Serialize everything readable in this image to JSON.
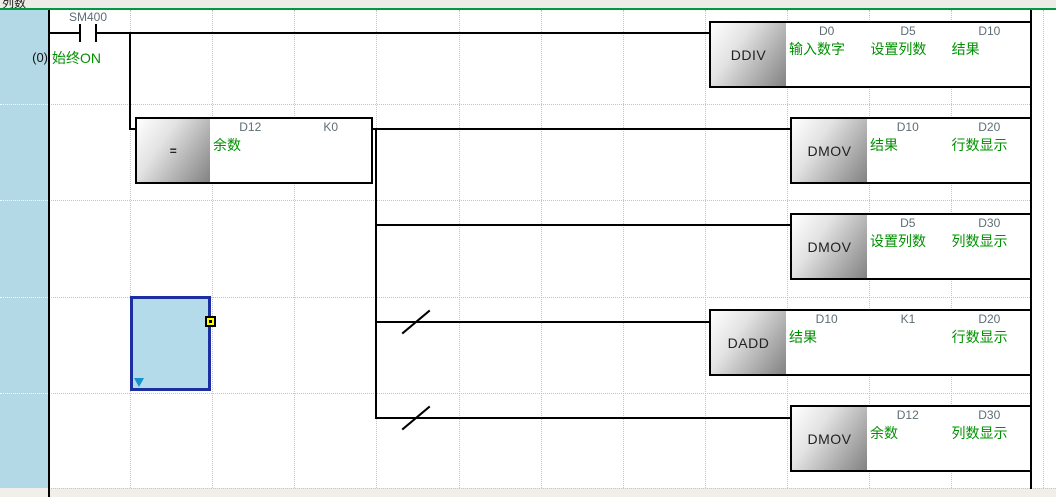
{
  "title_bar": {
    "comment": "列数"
  },
  "ladder": {
    "step_number": "(0)",
    "contact": {
      "device": "SM400",
      "comment": "始终ON"
    },
    "blocks": [
      {
        "instruction": "DDIV",
        "operands": [
          {
            "device": "D0",
            "comment": "输入数字"
          },
          {
            "device": "D5",
            "comment": "设置列数"
          },
          {
            "device": "D10",
            "comment": "结果"
          }
        ]
      },
      {
        "instruction": "=",
        "operands": [
          {
            "device": "D12",
            "comment": "余数"
          },
          {
            "device": "K0",
            "comment": ""
          }
        ]
      },
      {
        "instruction": "DMOV",
        "operands": [
          {
            "device": "D10",
            "comment": "结果"
          },
          {
            "device": "D20",
            "comment": "行数显示"
          }
        ]
      },
      {
        "instruction": "DMOV",
        "operands": [
          {
            "device": "D5",
            "comment": "设置列数"
          },
          {
            "device": "D30",
            "comment": "列数显示"
          }
        ]
      },
      {
        "instruction": "DADD",
        "operands": [
          {
            "device": "D10",
            "comment": "结果"
          },
          {
            "device": "K1",
            "comment": ""
          },
          {
            "device": "D20",
            "comment": "行数显示"
          }
        ]
      },
      {
        "instruction": "DMOV",
        "operands": [
          {
            "device": "D12",
            "comment": "余数"
          },
          {
            "device": "D30",
            "comment": "列数显示"
          }
        ]
      }
    ]
  },
  "colors": {
    "comment_green": "#009100",
    "device_gray": "#5f6d75",
    "sidebar_blue": "#b2d9e5",
    "separator_green": "#009845",
    "selection_border": "#1b2fa0",
    "selection_fill": "#b4dbe9",
    "handle_yellow": "#ffff00"
  }
}
